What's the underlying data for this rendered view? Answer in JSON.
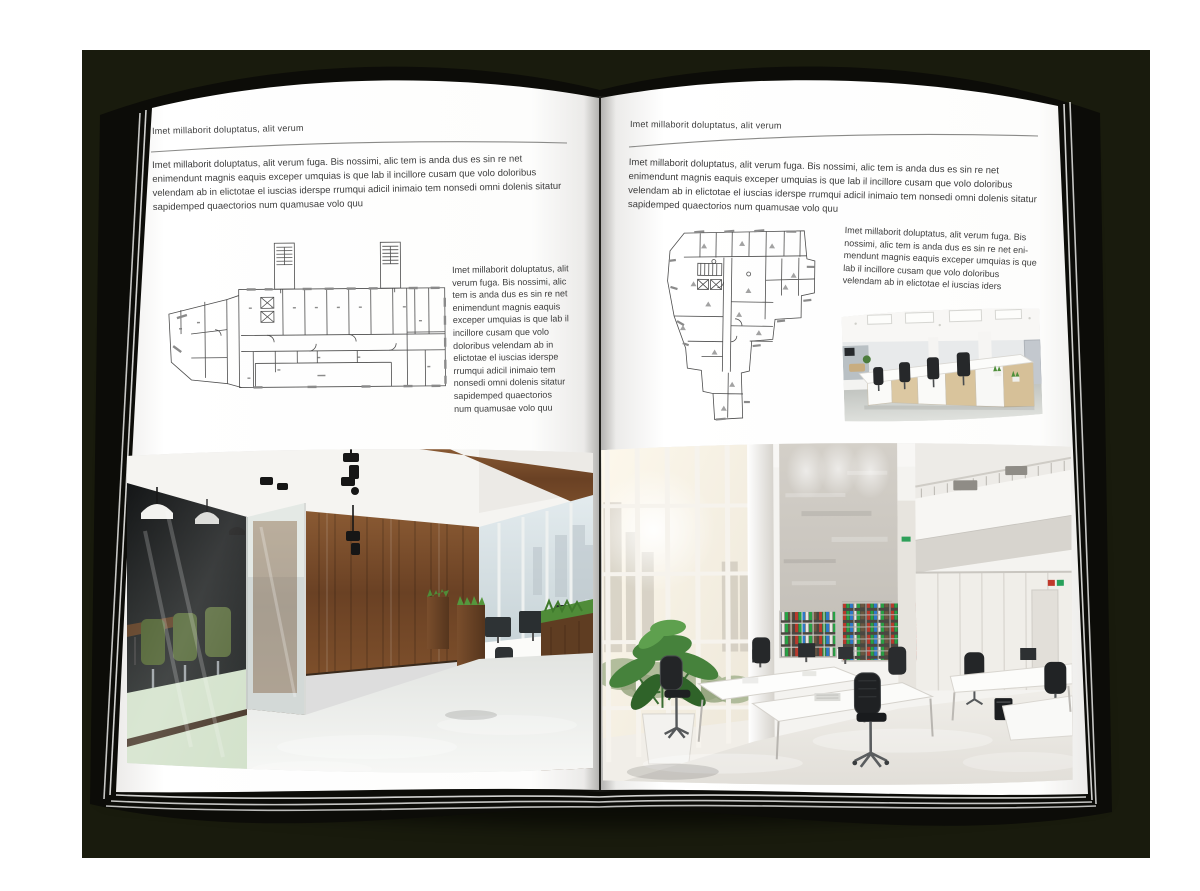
{
  "palette": {
    "backdrop": "#191b0d",
    "cover": "#0c0c08",
    "page": "#ffffff",
    "text": "#3d3d3d",
    "rule": "#8a8a88",
    "wood": "#7a4e2c",
    "chair_green": "#4c5f2e",
    "binder_red": "#b9392c",
    "binder_green": "#27a144",
    "binder_blue": "#2e79c8",
    "plant_green": "#46823c"
  },
  "left_page": {
    "header": "Imet millaborit doluptatus, alit verum",
    "intro": "Imet millaborit doluptatus, alit verum fuga. Bis nossimi, alic tem is anda dus es sin re net enimendunt magnis eaquis exceper umquias is que lab il incillore cusam que volo doloribus velendam ab in elictotae el iuscias iderspe rrumqui adicil inimaio tem nonsedi omni dolenis sitatur sapidemped quaectorios num quamusae volo quu",
    "floor_plan_alt": "rectangular-office-building-floor-plan-with-two-stair-towers",
    "side_text": "Imet millaborit doluptatus, alit verum fuga. Bis nossimi, alic tem is anda dus es sin re net enimendunt magnis eaquis exceper umquias is que lab il incillore cusam que volo doloribus velendam ab in elictotae el iuscias iderspe rrumqui adicil inimaio tem nonsedi omni dolenis sitatur sapidemped quaectorios num quamusae volo quu",
    "photo_alt": "loft-office-with-glass-meeting-room-green-chairs-and-wood-wall"
  },
  "right_page": {
    "header": "Imet millaborit doluptatus, alit verum",
    "intro": "Imet millaborit doluptatus, alit verum fuga. Bis nossimi, alic tem is anda dus es sin re net enimendunt magnis eaquis exceper umquias is que lab il incillore cusam que volo doloribus velendam ab in elictotae el iuscias iderspe rrumqui adicil inimaio tem nonsedi omni dolenis sitatur sapidemped quaectorios num quamusae volo quu",
    "floor_plan_alt": "irregular-polygonal-office-building-floor-plan",
    "side_text": "Imet millaborit doluptatus, alit verum fuga. Bis nossimi, alic tem is anda dus es sin re net eni- mendunt magnis eaquis exceper umquias is que lab il incillore cusam que volo doloribus velendam ab in elictotae el iuscias iders",
    "small_photo_alt": "open-plan-office-bay-with-white-desks-and-black-chairs",
    "photo_alt": "bright-atrium-office-with-binder-shelves-and-large-plant"
  }
}
